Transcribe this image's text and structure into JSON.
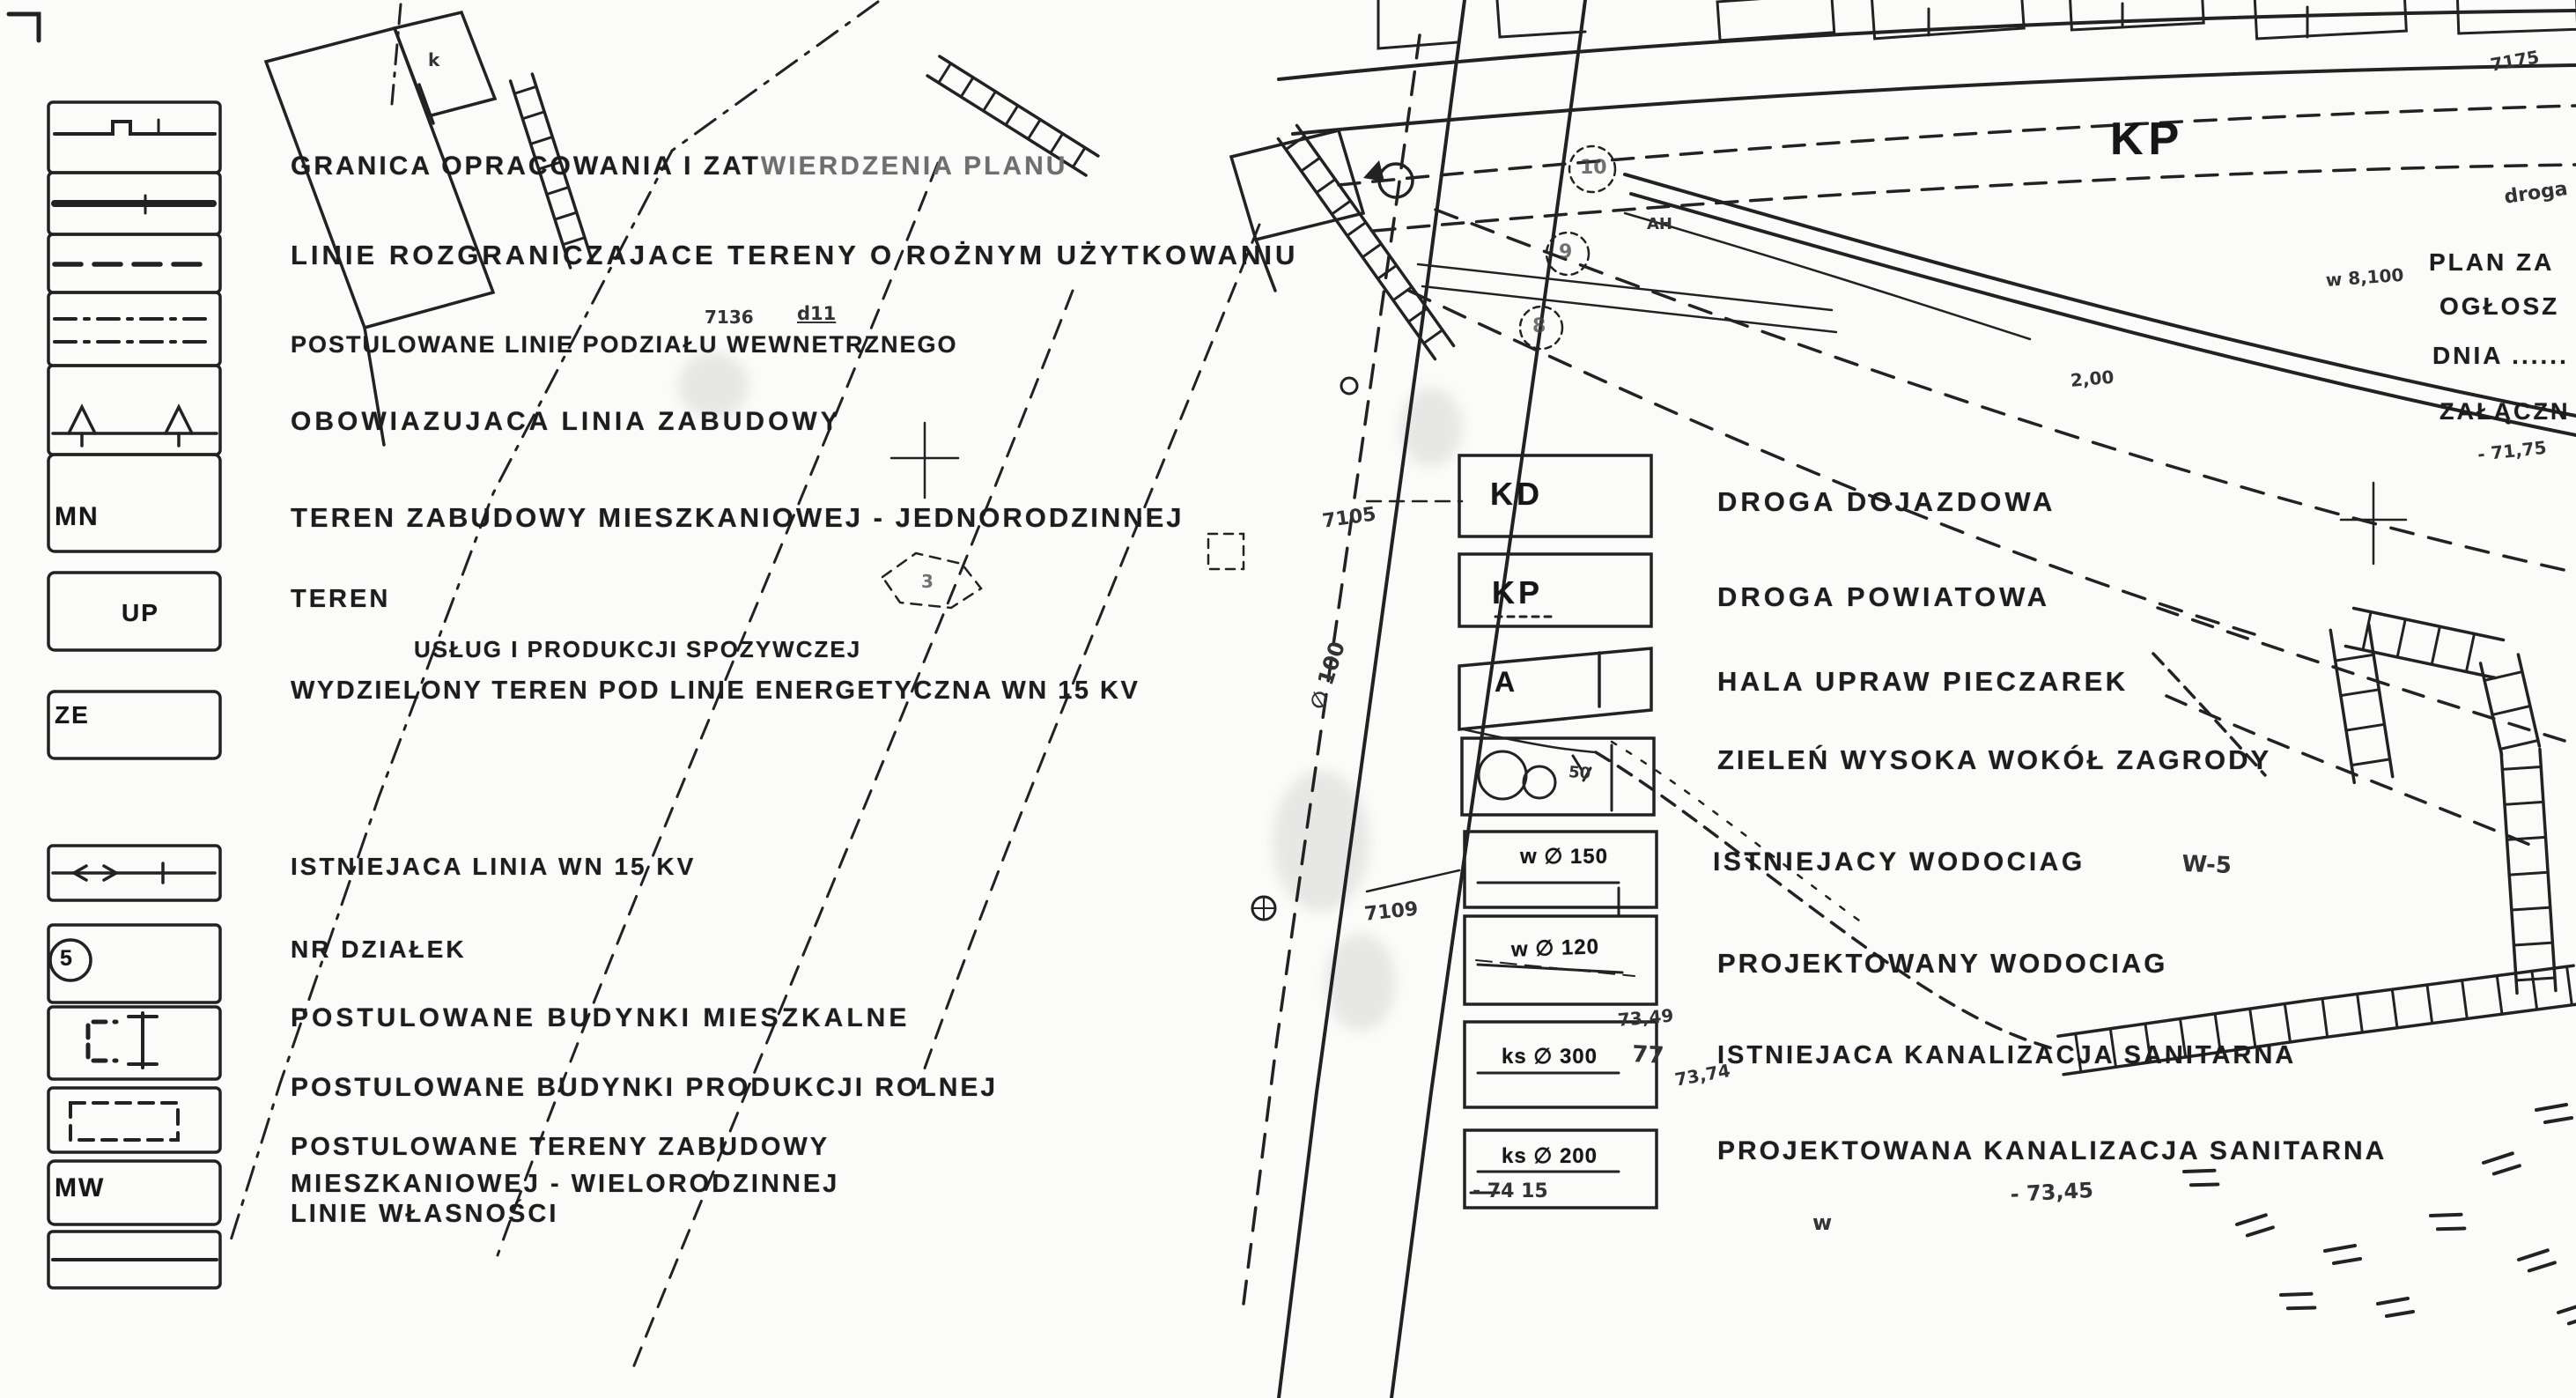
{
  "document": {
    "kind": "scanned zoning plan legend",
    "language": "Polish"
  },
  "colors": {
    "paper": "#fbfbf9",
    "ink": "#1d1d1d",
    "faint_ink": "#6e6e6e",
    "scribble_ink": "#333333"
  },
  "legend_left": {
    "row1": {
      "label": "GRANICA OPRACOWANIA I ZAT",
      "label_faint": "WIERDZENIA PLANU"
    },
    "row2": {
      "label": "LINIE ROZGRANICZAJACE TERENY O ROŻNYM UŻYTKOWANIU"
    },
    "row3": {
      "note_left": "7136",
      "note_right": "d11",
      "label": "POSTULOWANE LINIE PODZIAŁU WEWNETRZNEGO"
    },
    "row4": {
      "label": "OBOWIAZUJACA LINIA ZABUDOWY"
    },
    "row5": {
      "code": "MN",
      "label": "TEREN ZABUDOWY MIESZKANIOWEJ - JEDNORODZINNEJ"
    },
    "row6": {
      "code": "UP",
      "label": "TEREN",
      "label2": "USŁUG I PRODUKCJI SPOZYWCZEJ"
    },
    "row7": {
      "code": "ZE",
      "label": "WYDZIELONY TEREN POD LINIE ENERGETYCZNA WN 15 KV"
    },
    "row8": {
      "label": "ISTNIEJACA LINIA WN 15 KV"
    },
    "row9": {
      "symbol_number": "5",
      "label": "NR DZIAŁEK"
    },
    "row10": {
      "label": "POSTULOWANE BUDYNKI MIESZKALNE"
    },
    "row11": {
      "label": "POSTULOWANE BUDYNKI PRODUKCJI ROLNEJ"
    },
    "row12": {
      "code": "MW",
      "label": "POSTULOWANE TERENY ZABUDOWY",
      "label2": "MIESZKANIOWEJ - WIELORODZINNEJ"
    },
    "row13": {
      "label": "LINIE WŁASNOŚCI"
    }
  },
  "legend_right": {
    "row_kd": {
      "code": "KD",
      "label": "DROGA DOJAZDOWA"
    },
    "row_kp": {
      "code": "KP",
      "label": "DROGA POWIATOWA"
    },
    "row_a": {
      "code": "A",
      "label": "HALA UPRAW PIECZAREK"
    },
    "row_zielen": {
      "label": "ZIELEŃ WYSOKA WOKÓŁ ZAGRODY"
    },
    "row_w150": {
      "code": "w ∅ 150",
      "label": "ISTNIEJACY WODOCIAG",
      "suffix": "W-5"
    },
    "row_w120": {
      "code": "w ∅ 120",
      "label": "PROJEKTOWANY WODOCIAG"
    },
    "row_ks300": {
      "code": "ks ∅ 300",
      "label": "ISTNIEJACA KANALIZACJA SANITARNA"
    },
    "row_ks200": {
      "code": "ks ∅ 200",
      "sub": "- 74 15",
      "label": "PROJEKTOWANA KANALIZACJA SANITARNA"
    }
  },
  "map": {
    "kp_road_label": "KP",
    "corner_texts": {
      "plan": "PLAN ZA",
      "oglosz": "OGŁOSZ",
      "dnia": "DNIA ......",
      "zalacznik": "ZAŁĄCZN"
    },
    "building_label": "k",
    "parcel_numbers": {
      "p1": "10",
      "p2": "9",
      "p3": "8",
      "p4": "3"
    },
    "annotations": {
      "a1": "7105",
      "a2": "∅ 100",
      "a3": "7109",
      "a4": "AH",
      "a5": "73,49",
      "a6": "77",
      "a7": "73,74",
      "a8": "- 73,45",
      "a9": "2,00",
      "a10": "w 8,100",
      "a11": "7175",
      "a12": "- 71,75",
      "a13": "droga",
      "a14": "w",
      "a15": "50"
    }
  }
}
